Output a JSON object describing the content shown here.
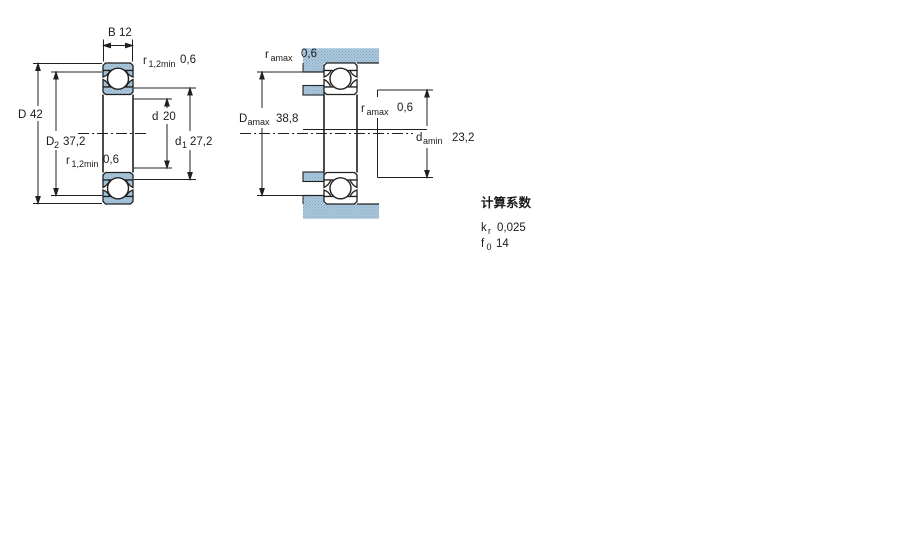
{
  "left_view": {
    "width": {
      "sym": "B",
      "sub": "",
      "val": "12"
    },
    "outer_dia": {
      "sym": "D",
      "sub": "",
      "val": "42"
    },
    "shoulder_outer": {
      "sym": "D",
      "sub": "2",
      "val": "37,2"
    },
    "bore": {
      "sym": "d",
      "sub": "",
      "val": "20"
    },
    "shoulder_inner": {
      "sym": "d",
      "sub": "1",
      "val": "27,2"
    },
    "chamfer_top": {
      "sym": "r",
      "sub": "1,2min",
      "val": "0,6"
    },
    "chamfer_bottom": {
      "sym": "r",
      "sub": "1,2min",
      "val": "0,6"
    }
  },
  "right_view": {
    "fillet_top": {
      "sym": "r",
      "sub": "amax",
      "val": "0,6"
    },
    "housing_abutment": {
      "sym": "D",
      "sub": "amax",
      "val": "38,8"
    },
    "fillet_mid": {
      "sym": "r",
      "sub": "amax",
      "val": "0,6"
    },
    "shaft_abutment": {
      "sym": "d",
      "sub": "amin",
      "val": "23,2"
    }
  },
  "calculation_factors": {
    "title": "计算系数",
    "kr": {
      "sym": "k",
      "sub": "r",
      "val": "0,025"
    },
    "f0": {
      "sym": "f",
      "sub": "0",
      "val": "14"
    }
  },
  "colors": {
    "hatch_base": "#abc8dd",
    "hatch_dot": "#84a6bf",
    "line": "#202020"
  }
}
